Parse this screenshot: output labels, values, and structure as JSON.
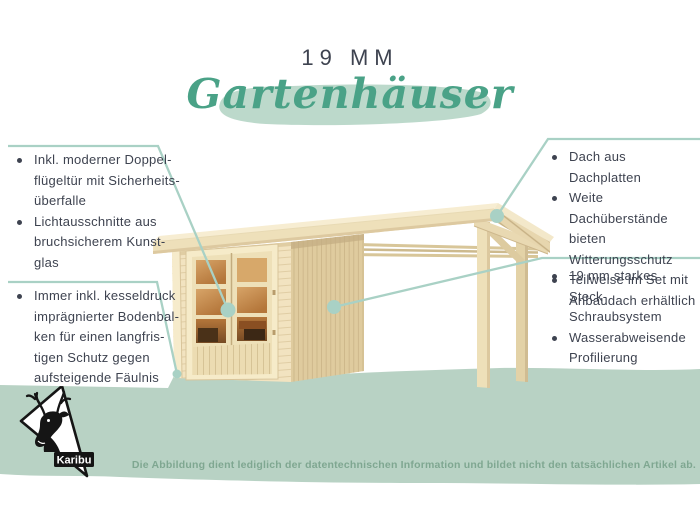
{
  "header": {
    "title": "19 MM",
    "subtitle": "Gartenhäuser"
  },
  "features": {
    "top_left": [
      "Inkl. moderner Doppel-\nflügeltür mit Sicherheits-\nüberfalle",
      "Lichtausschnitte aus\nbruchsicherem Kunst-\nglas"
    ],
    "bottom_left": [
      "Immer inkl. kesseldruck\nimprägnierter Bodenbal-\nken für einen langfris-\ntigen Schutz gegen\naufsteigende Fäulnis"
    ],
    "top_right": [
      "Dach aus Dachplatten",
      "Weite Dachüberstände\nbieten Witterungsschutz",
      "Teilweise im Set mit\nAnbaudach erhältlich"
    ],
    "bottom_right": [
      "19 mm starkes Steck-\nSchraubsystem",
      "Wasserabweisende\nProfilierung"
    ]
  },
  "footer": {
    "disclaimer": "Die Abbildung dient lediglich der datentechnischen Information und bildet nicht den tatsächlichen Artikel ab."
  },
  "logo": {
    "brand": "Karibu",
    "icon": "deer-head-icon"
  },
  "colors": {
    "accent_green": "#4aa287",
    "brush_green": "#bcd9cb",
    "band_green": "#b8d2c4",
    "line_teal": "#a9d1c5",
    "text_dark": "#3e4350",
    "disclaimer_green": "#7fa791",
    "logo_black": "#151515"
  }
}
